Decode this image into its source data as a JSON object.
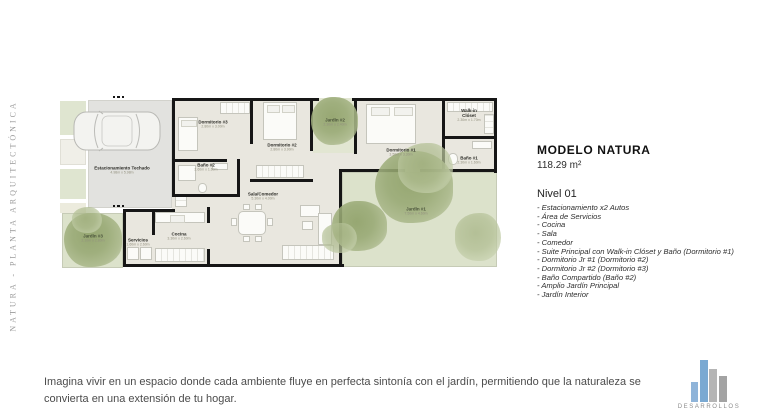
{
  "slide": {
    "side_label": "NATURA - PLANTA ARQUITECTÓNICA",
    "tagline": "Imagina vivir en un espacio donde cada ambiente fluye en perfecta sintonía con el jardín, permitiendo que la naturaleza se convierta en una extensión de tu hogar."
  },
  "info": {
    "model_title": "MODELO NATURA",
    "area": "118.29 m²",
    "level_title": "Nivel 01",
    "features": [
      "- Estacionamiento x2 Autos",
      "- Área de Servicios",
      "- Cocina",
      "- Sala",
      "- Comedor",
      "- Suite Principal con Walk-in Clóset y Baño (Dormitorio #1)",
      "- Dormitorio Jr #1 (Dormitorio #2)",
      "- Dormitorio Jr #2 (Dormitorio #3)",
      "- Baño Compartido (Baño #2)",
      "- Amplio Jardín Principal",
      "- Jardín Interior"
    ]
  },
  "plan": {
    "rooms": [
      {
        "name": "Estacionamiento Techado",
        "dim": "4.98m x 5.98m"
      },
      {
        "name": "Dormitorio #3",
        "dim": "2.80m x 3.00m"
      },
      {
        "name": "Baño #2",
        "dim": "2.60m x 1.60m"
      },
      {
        "name": "Dormitorio #2",
        "dim": "2.80m x 3.90m"
      },
      {
        "name": "Jardín #2",
        "dim": "2.30m x 2.40m"
      },
      {
        "name": "Dormitorio #1",
        "dim": "3.50m x 3.30m"
      },
      {
        "name": "Walk-in Clóset",
        "dim": "2.30m x 1.70m"
      },
      {
        "name": "Baño #1",
        "dim": "2.30m x 1.60m"
      },
      {
        "name": "Sala/Comedor",
        "dim": "5.30m x 4.00m"
      },
      {
        "name": "Cocina",
        "dim": "3.30m x 2.60m"
      },
      {
        "name": "Servicios",
        "dim": "1.60m x 2.60m"
      },
      {
        "name": "Jardín #3",
        "dim": "2.10m x 2.80m"
      },
      {
        "name": "Jardín #1",
        "dim": "7.50m x 4.60m"
      }
    ]
  },
  "logo": {
    "company": "DESARROLLOS"
  },
  "colors": {
    "logo_blue": "#7aa9d2",
    "logo_gray": "#b2b2b2",
    "garden_green": "#dce2cb",
    "tree_green": "#8d9f66",
    "wall_black": "#161616"
  }
}
